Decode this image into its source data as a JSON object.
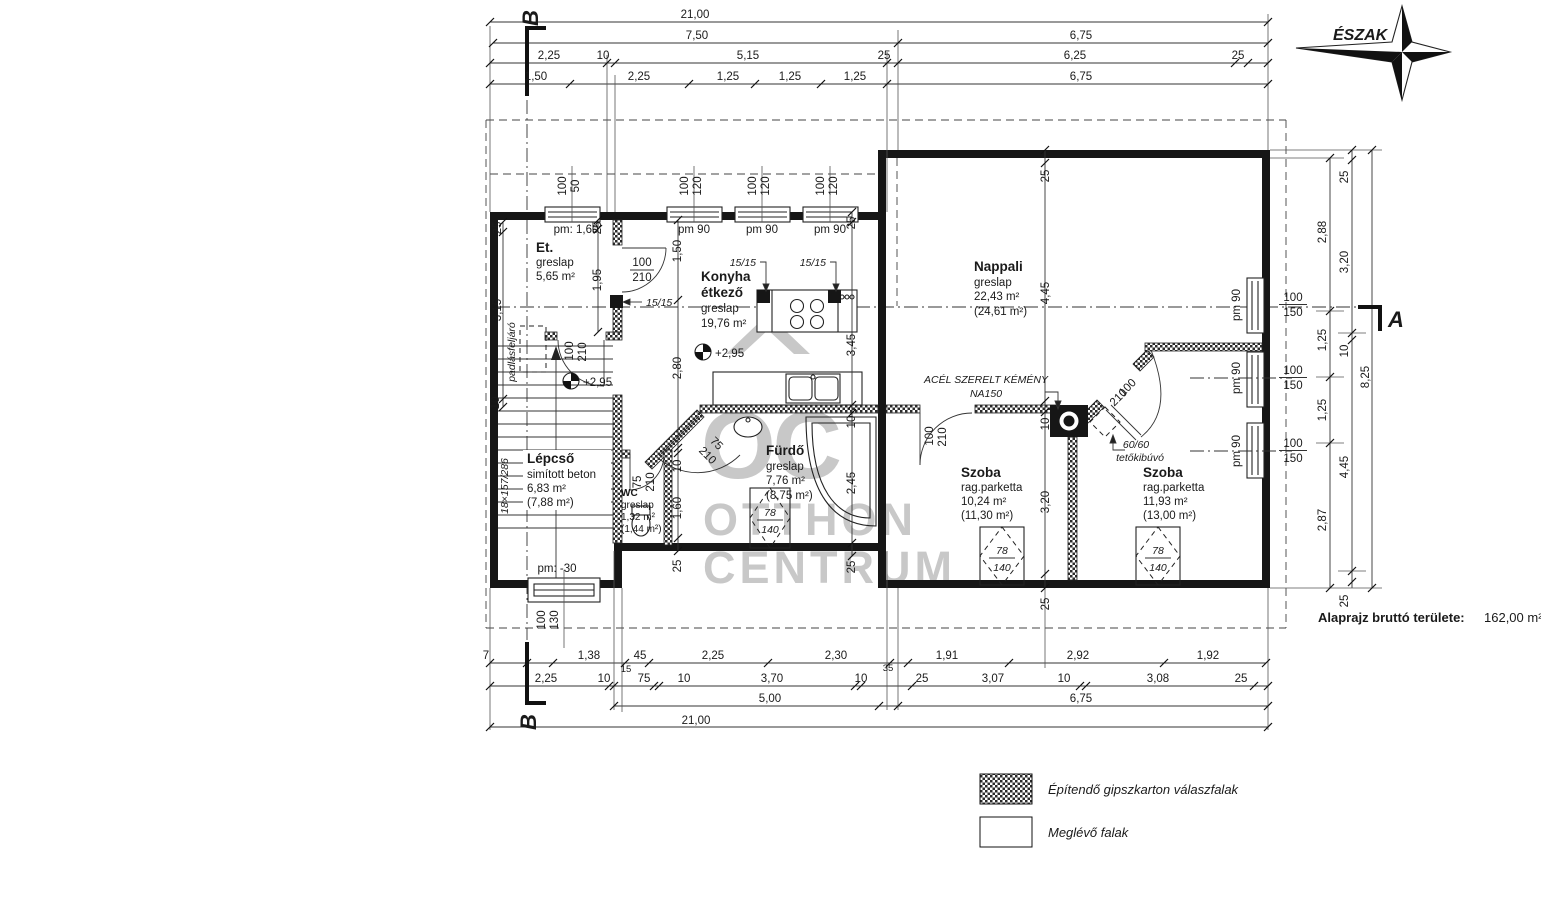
{
  "labels": {
    "north": "ÉSZAK",
    "sec_a": "A",
    "sec_b": "B",
    "pm160": "pm: 1,60",
    "pm90": "pm 90",
    "pm30": "pm: -30",
    "level": "+2,95",
    "w100": "100",
    "w50": "50",
    "w120": "120",
    "w150": "150",
    "w130": "130",
    "rw78": "78",
    "rw140": "140",
    "d100": "100",
    "d210": "210",
    "d75": "75",
    "col1515": "15/15",
    "chimney1": "ACÉL SZERELT KÉMÉNY",
    "chimney2": "NA150",
    "roofhatch1": "60/60",
    "roofhatch2": "tetőkibúvó",
    "attic": "padlásfeljáró",
    "note_label": "Alaprajz bruttó területe:",
    "note_value": "162,00 m²",
    "legend_new": "Építendő gipszkarton válaszfalak",
    "legend_existing": "Meglévő falak",
    "wm_logo": "OC",
    "wm_line1": "OTTHON",
    "wm_line2": "CENTRUM"
  },
  "rooms": {
    "et": {
      "name": "Et.",
      "finish": "greslap",
      "area": "5,65 m²"
    },
    "konyha": {
      "name": "Konyha",
      "name2": "étkező",
      "finish": "greslap",
      "area": "19,76 m²"
    },
    "nappali": {
      "name": "Nappali",
      "finish": "greslap",
      "area": "22,43 m²",
      "area_gross": "(24,61 m²)"
    },
    "lepcso": {
      "name": "Lépcső",
      "finish": "simított beton",
      "area": "6,83 m²",
      "area_gross": "(7,88 m²)",
      "steps": "18×157/286"
    },
    "wc": {
      "name": "WC",
      "finish": "greslap",
      "area": "1,32 m²",
      "area_gross": "(1,44 m²)"
    },
    "furdo": {
      "name": "Fürdő",
      "finish": "greslap",
      "area": "7,76 m²",
      "area_gross": "(8,75 m²)"
    },
    "szoba1": {
      "name": "Szoba",
      "finish": "rag.parketta",
      "area": "10,24 m²",
      "area_gross": "(11,30 m²)"
    },
    "szoba2": {
      "name": "Szoba",
      "finish": "rag.parketta",
      "area": "11,93 m²",
      "area_gross": "(13,00 m²)"
    }
  },
  "d": {
    "t1": [
      "21,00"
    ],
    "t2": [
      "7,50",
      "6,75"
    ],
    "t3": [
      "2,25",
      "10",
      "5,15",
      "25",
      "6,25",
      "25"
    ],
    "t4": [
      "1,50",
      "2,25",
      "1,25",
      "1,25",
      "1,25",
      "6,75"
    ],
    "b1": [
      "7",
      "1,38",
      "45",
      "15",
      "2,25",
      "2,30",
      "35",
      "1,91",
      "2,92",
      "1,92"
    ],
    "b2": [
      "2,25",
      "10",
      "75",
      "10",
      "3,70",
      "10",
      "25",
      "3,07",
      "10",
      "3,08",
      "25"
    ],
    "b3": [
      "5,00",
      "6,75"
    ],
    "b4": [
      "21,00"
    ],
    "r1": [
      "2,88",
      "1,25",
      "1,25",
      "2,87"
    ],
    "r2": [
      "25",
      "3,20",
      "10",
      "4,45",
      "25"
    ],
    "r3": [
      "8,25"
    ],
    "v1": [
      "25",
      "3,15",
      "10"
    ],
    "v2": [
      "25",
      "1,95"
    ],
    "v3": [
      "1,50",
      "2,80",
      "10",
      "1,60",
      "25"
    ],
    "v4": [
      "25",
      "3,45",
      "10",
      "2,45",
      "25"
    ],
    "v5": [
      "25",
      "4,45",
      "10",
      "3,20",
      "25"
    ]
  }
}
